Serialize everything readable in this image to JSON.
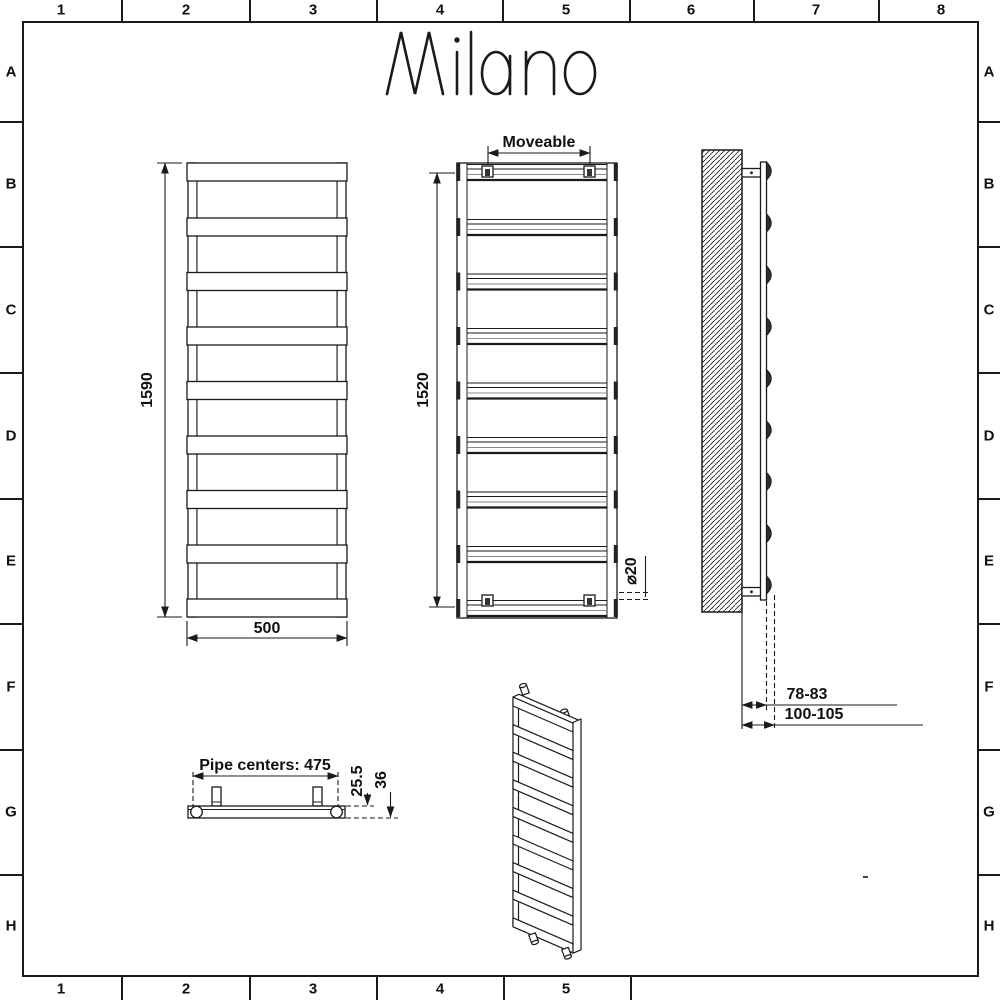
{
  "sheet": {
    "brand_logo": "Milano",
    "grid": {
      "top": [
        "1",
        "2",
        "3",
        "4",
        "5",
        "6",
        "7",
        "8"
      ],
      "bottom": [
        "1",
        "2",
        "3",
        "4",
        "5"
      ],
      "left": [
        "A",
        "B",
        "C",
        "D",
        "E",
        "F",
        "G",
        "H"
      ],
      "right": [
        "A",
        "B",
        "C",
        "D",
        "E",
        "F",
        "G",
        "H"
      ]
    }
  },
  "dimensions": {
    "front_height": "1590",
    "front_width": "500",
    "moveable": "Moveable",
    "rear_height": "1520",
    "tube_diameter": "⌀20",
    "wall_to_front_min": "78-83",
    "wall_to_front_max": "100-105",
    "pipe_centers": "Pipe centers: 475",
    "bracket_depth": "25.5",
    "total_depth": "36"
  },
  "colors": {
    "line": "#1a1a1a",
    "gray_line": "#8a8a8a",
    "dark_fill": "#2e2e2e",
    "background": "#ffffff"
  }
}
